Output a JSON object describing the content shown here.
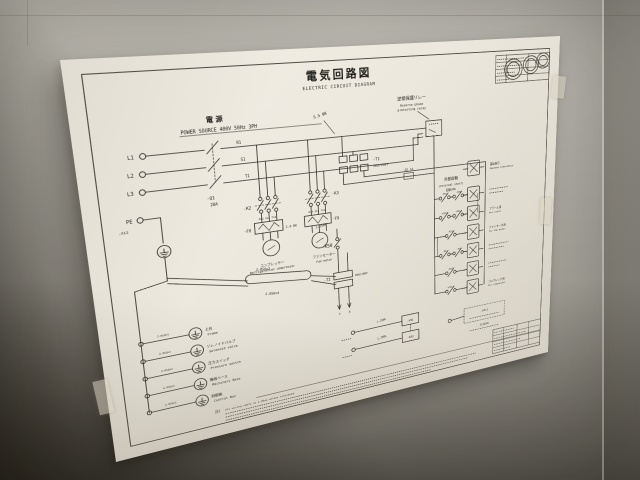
{
  "diagram": {
    "title": {
      "jp": "電気回路図",
      "en": "ELECTRIC CIRCUIT DIAGRAM"
    },
    "power": {
      "jp": "電 源",
      "en": "POWER SOURCE 400V 50Hz 3PH",
      "terminals": [
        "L1",
        "L2",
        "L3",
        "PE"
      ],
      "terminal_block": "-X12",
      "breaker_ref": "-Q1",
      "breaker_rating": "20A",
      "wires": [
        "R1",
        "S1",
        "T1"
      ],
      "gauge": "5.5 BK"
    },
    "relay": {
      "jp": "逆相保護リレー",
      "en1": "Reverse phase",
      "en2": "protecting relay"
    },
    "t1": {
      "ref": "-T1",
      "rating": "400/200V"
    },
    "t2": {
      "ref": "-T2",
      "rating": "200/100V",
      "tap1": "2",
      "tap2": "3"
    },
    "q2": "-Q2 1A",
    "branch": {
      "k2": "-K2",
      "k3": "-K3",
      "f8": "-F8",
      "f9": "-F9",
      "k2_wires": "R12 S12 T12",
      "k3_wires": "R14 S14 T14",
      "gauge": "2.0 BK"
    },
    "motors": [
      {
        "jp": "コンプレッサー",
        "en": "Refrigeration compressor"
      },
      {
        "jp": "ファンモーター",
        "en": "Fan motor"
      }
    ],
    "control": {
      "wire_bk": "1.25BK",
      "k50": "-K50",
      "ext_jp": "外部起動",
      "ext_en": "(External start)",
      "pb": "起動(PB)"
    },
    "refs": {
      "c1": "-F51",
      "c2": "-K50",
      "c3": "-K512",
      "c4": "-K513",
      "c5": "-K51",
      "c6": "-F8",
      "c7": "-F9",
      "c8": "-K52",
      "c9": "-K511"
    },
    "coils": [
      {
        "jp": "運転表示",
        "en": "Operate indication"
      },
      {
        "jp": "アラーム用",
        "en": "For alarm"
      },
      {
        "jp": "ファンモータ用",
        "en": "For fan motor"
      },
      {
        "jp": "コンプレッサ用",
        "en": "For compressor"
      }
    ],
    "cables": {
      "spec1": "2.0SQ×2",
      "spec2": "2.0SQ×4",
      "bl": "1.25BL",
      "closed": "CLOSED"
    },
    "legend": {
      "wire": "2.0SQ×1",
      "items": [
        {
          "jp": "土台",
          "en": "Frame"
        },
        {
          "jp": "ソレノイドバルブ",
          "en": "Solenoid valve"
        },
        {
          "jp": "圧力スイッチ",
          "en": "Pressure switch"
        },
        {
          "jp": "機械ベース",
          "en": "Machinery Base"
        },
        {
          "jp": "制御箱",
          "en": "Control Box"
        }
      ]
    },
    "notes": {
      "marker": "注)",
      "line1": "All wiring cable is 1.25sq unless indicated."
    }
  }
}
